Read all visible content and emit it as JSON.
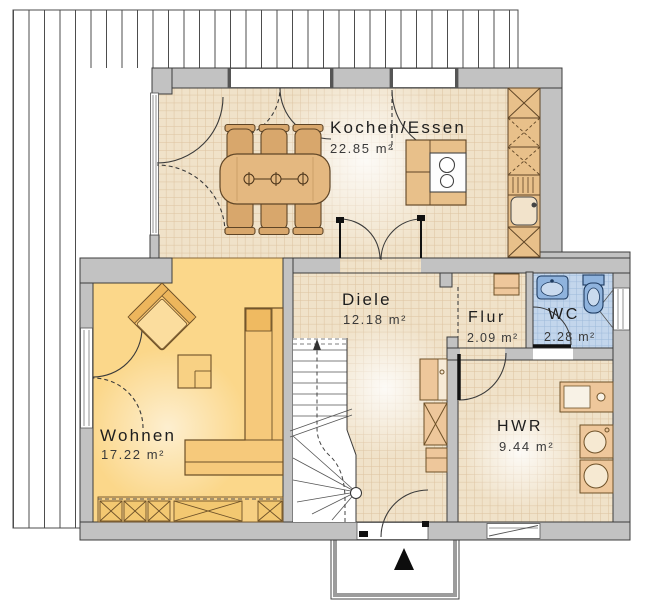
{
  "plan": {
    "rooms": [
      {
        "name": "Kochen/Essen",
        "area": "22.85 m²"
      },
      {
        "name": "Diele",
        "area": "12.18 m²"
      },
      {
        "name": "Flur",
        "area": "2.09 m²"
      },
      {
        "name": "WC",
        "area": "2.28 m²"
      },
      {
        "name": "Wohnen",
        "area": "17.22 m²"
      },
      {
        "name": "HWR",
        "area": "9.44 m²"
      }
    ],
    "colors": {
      "wall": "#c2c2c2",
      "tile_floor": "#f0e2c9",
      "tile_grid": "#ddc3a0",
      "living_floor": "#fbd78a",
      "wc_floor": "#c3d6ec",
      "furniture": "#e8c08a",
      "deck_line": "#4d4d4d"
    }
  }
}
